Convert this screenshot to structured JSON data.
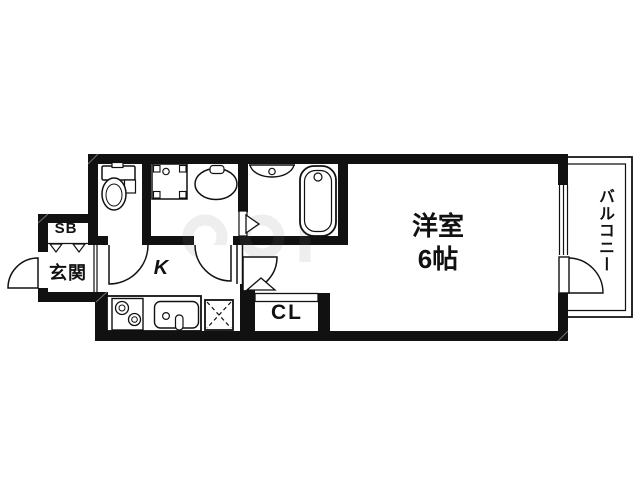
{
  "floorplan": {
    "labels": {
      "shoe_box": "SB",
      "entrance": "玄関",
      "kitchen": "K",
      "closet": "CL",
      "main_room_name": "洋室",
      "main_room_size": "6帖",
      "balcony": "バルコニー"
    },
    "colors": {
      "wall": "#111111",
      "line": "#111111",
      "background": "#ffffff"
    }
  }
}
